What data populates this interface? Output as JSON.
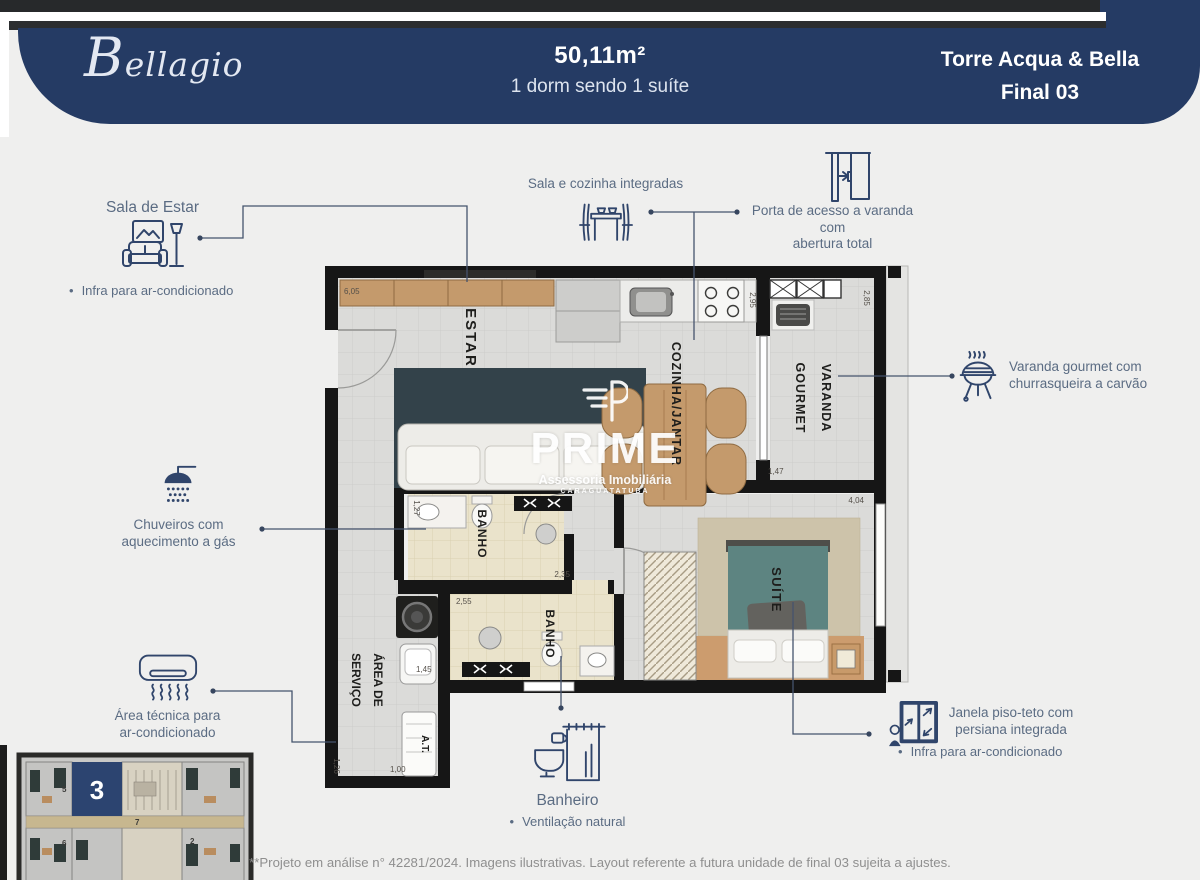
{
  "header": {
    "brand": "Bellagio",
    "area": "50,11m²",
    "program": "1 dorm sendo 1 suíte",
    "tower": "Torre Acqua & Bella",
    "unit": "Final 03"
  },
  "callouts": {
    "sala_estar": {
      "title": "Sala de Estar",
      "bullet": "Infra para ar-condicionado",
      "icon": "sofa-lamp-icon"
    },
    "cozinha_integrada": {
      "title": "Sala e cozinha integradas",
      "icon": "dining-table-icon"
    },
    "porta_varanda": {
      "line1": "Porta de acesso a varanda com",
      "line2": "abertura total",
      "icon": "sliding-door-icon"
    },
    "varanda_gourmet": {
      "line1": "Varanda gourmet com",
      "line2": "churrasqueira a carvão",
      "icon": "bbq-grill-icon"
    },
    "chuveiros": {
      "line1": "Chuveiros com",
      "line2": "aquecimento a gás",
      "icon": "shower-icon"
    },
    "area_tecnica": {
      "line1": "Área técnica para",
      "line2": "ar-condicionado",
      "icon": "ac-unit-icon"
    },
    "janela": {
      "line1": "Janela piso-teto com",
      "line2": "persiana integrada",
      "bullet": "Infra para ar-condicionado",
      "icon": "window-person-icon"
    },
    "banheiro": {
      "title": "Banheiro",
      "bullet": "Ventilação natural",
      "icon": "toilet-shower-icon"
    }
  },
  "plan": {
    "rooms": {
      "estar": "ESTAR",
      "cozinha": "COZINHA/JANTAR",
      "varanda1": "VARANDA",
      "varanda2": "GOURMET",
      "banho1": "BANHO",
      "banho2": "BANHO",
      "suite": "SUÍTE",
      "servico1": "ÁREA DE",
      "servico2": "SERVIÇO",
      "at": "A.T."
    },
    "dims": {
      "estar_w": "6,05",
      "coz_h": "2,95",
      "var_h": "2,85",
      "var_w": "1,47",
      "suite_w": "4,04",
      "banho1_w": "2,35",
      "banho2_w": "2,55",
      "banho1_h": "1,27",
      "serv_w": "1,45",
      "at_w": "1,00",
      "at_h": "1,26"
    }
  },
  "watermark": {
    "name": "PRIME",
    "tagline": "Assessoria Imobiliária",
    "city": "CARAGUATATUBA",
    "icon": "prime-logo"
  },
  "keyplan": {
    "highlight": "3",
    "units": {
      "u5": "5",
      "u6": "6",
      "u7": "7",
      "u2": "2"
    }
  },
  "footer": {
    "note": "**Projeto em análise n° 42281/2024. Imagens ilustrativas. Layout referente a futura unidade de final 03 sujeita a ajustes."
  },
  "colors": {
    "navy": "#253b64",
    "icon_ink": "#30456b",
    "callout_text": "#5b6c83",
    "wall": "#161616",
    "grey_floor": "#dbdbd9",
    "beige_floor": "#eae3cb",
    "wood": "#c49a6c",
    "rug": "#33424a",
    "bed_teal": "#5d8481",
    "keyplan_navy": "#2c4470"
  }
}
